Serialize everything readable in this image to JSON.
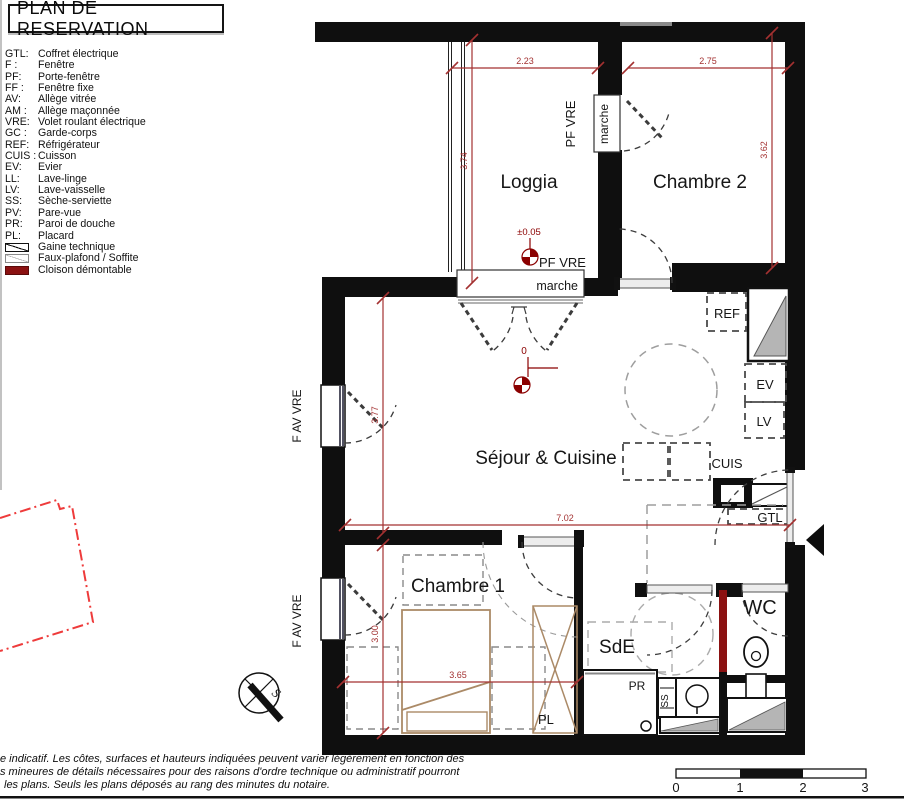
{
  "title": "PLAN DE RESERVATION",
  "legend": {
    "entries": [
      {
        "abbr": "GTL:",
        "label": "Coffret électrique"
      },
      {
        "abbr": "F :",
        "label": "Fenêtre"
      },
      {
        "abbr": "PF:",
        "label": "Porte-fenêtre"
      },
      {
        "abbr": "FF :",
        "label": "Fenêtre fixe"
      },
      {
        "abbr": "AV:",
        "label": "Allège vitrée"
      },
      {
        "abbr": "AM :",
        "label": "Allège maçonnée"
      },
      {
        "abbr": "VRE:",
        "label": "Volet roulant électrique"
      },
      {
        "abbr": "GC :",
        "label": "Garde-corps"
      },
      {
        "abbr": "REF:",
        "label": "Réfrigérateur"
      },
      {
        "abbr": "CUIS :",
        "label": "Cuisson"
      },
      {
        "abbr": "EV:",
        "label": "Evier"
      },
      {
        "abbr": "LL:",
        "label": "Lave-linge"
      },
      {
        "abbr": "LV:",
        "label": "Lave-vaisselle"
      },
      {
        "abbr": "SS:",
        "label": "Sèche-serviette"
      },
      {
        "abbr": "PV:",
        "label": "Pare-vue"
      },
      {
        "abbr": "PR:",
        "label": "Paroi de douche"
      },
      {
        "abbr": "PL:",
        "label": "Placard"
      }
    ],
    "symbols": [
      {
        "label": "Gaine technique"
      },
      {
        "label": "Faux-plafond / Soffite"
      },
      {
        "label": "Cloison démontable"
      }
    ]
  },
  "rooms": {
    "loggia": "Loggia",
    "chambre2": "Chambre 2",
    "sejour": "Séjour & Cuisine",
    "chambre1": "Chambre 1",
    "sde": "SdE",
    "wc": "WC"
  },
  "fixtures": {
    "ref": "REF",
    "ev": "EV",
    "lv": "LV",
    "cuis": "CUIS",
    "gtl": "GTL",
    "pr": "PR",
    "ss": "SS",
    "pl": "PL"
  },
  "openings": {
    "pf_vre_top": "PF VRE",
    "marche_top": "marche",
    "pf_vre_bottom": "PF VRE",
    "marche_bottom": "marche",
    "f_av_vre_1": "F AV VRE",
    "f_av_vre_2": "F AV VRE"
  },
  "dimensions": {
    "loggia_width": "2.23",
    "chambre2_width": "2.75",
    "loggia_height": "3.74",
    "chambre2_height": "3.62",
    "sejour_height": "3.77",
    "sejour_width": "7.02",
    "chambre1_width": "3.65",
    "chambre1_height": "3.00"
  },
  "levels": {
    "loggia": "±0.05",
    "sejour": "0"
  },
  "compass": {
    "label": "S"
  },
  "scale_bar": {
    "labels": [
      "0",
      "1",
      "2",
      "3"
    ]
  },
  "disclaimer": {
    "line1": "e indicatif. Les côtes, surfaces et hauteurs indiquées peuvent varier légèrement en fonction des",
    "line2": "s mineures de détails nécessaires pour des raisons d'ordre technique ou administratif pourront",
    "line3": "les plans. Seuls les plans déposés au rang des minutes du notaire."
  },
  "colors": {
    "wall": "#0f0f0f",
    "dimension": "#a33131",
    "level_marker": "#8b0000",
    "cloison_demontable": "#8b1111",
    "neighbor_outline": "#ee3b3b",
    "furniture": "#ab8a67",
    "duct_fill": "#b5b5b5"
  }
}
